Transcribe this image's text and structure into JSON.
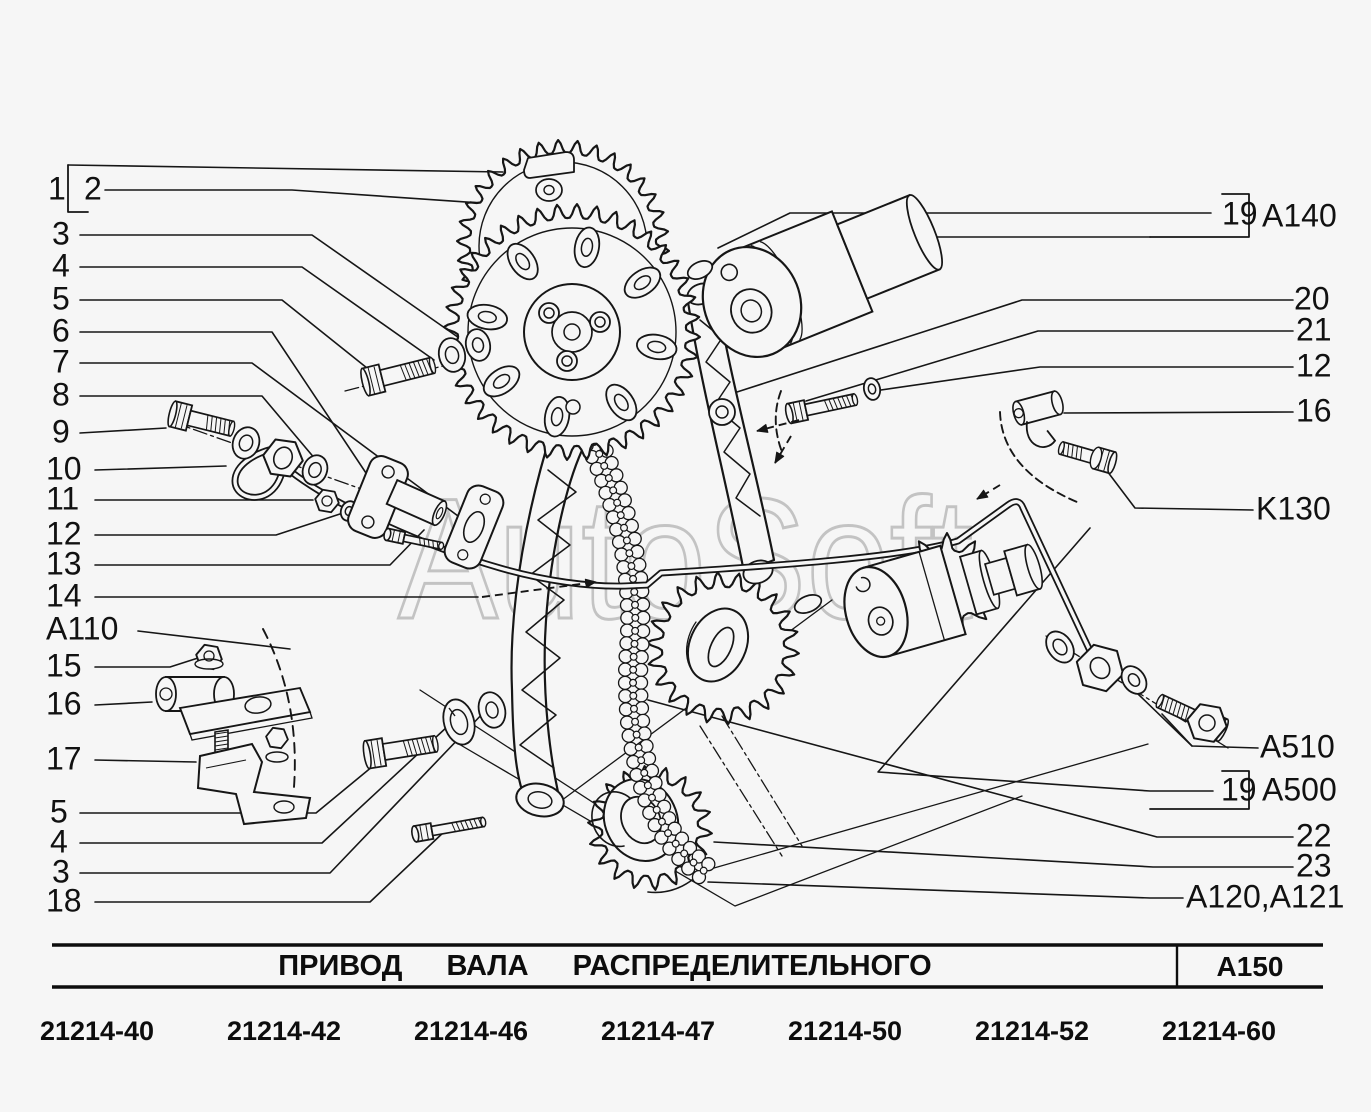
{
  "watermark": "AutoSoft",
  "callouts": {
    "left": [
      {
        "label": "1",
        "x": 48,
        "y": 190
      },
      {
        "label": "2",
        "x": 84,
        "y": 190,
        "boxed": true
      },
      {
        "label": "3",
        "x": 52,
        "y": 235
      },
      {
        "label": "4",
        "x": 52,
        "y": 267
      },
      {
        "label": "5",
        "x": 52,
        "y": 300
      },
      {
        "label": "6",
        "x": 52,
        "y": 332
      },
      {
        "label": "7",
        "x": 52,
        "y": 363
      },
      {
        "label": "8",
        "x": 52,
        "y": 396
      },
      {
        "label": "9",
        "x": 52,
        "y": 433
      },
      {
        "label": "10",
        "x": 46,
        "y": 470
      },
      {
        "label": "11",
        "x": 46,
        "y": 500
      },
      {
        "label": "12",
        "x": 46,
        "y": 535
      },
      {
        "label": "13",
        "x": 46,
        "y": 565
      },
      {
        "label": "14",
        "x": 46,
        "y": 597
      },
      {
        "label": "A110",
        "x": 46,
        "y": 630
      },
      {
        "label": "15",
        "x": 46,
        "y": 667
      },
      {
        "label": "16",
        "x": 46,
        "y": 705
      },
      {
        "label": "17",
        "x": 46,
        "y": 760
      },
      {
        "label": "5",
        "x": 50,
        "y": 813
      },
      {
        "label": "4",
        "x": 50,
        "y": 843
      },
      {
        "label": "3",
        "x": 52,
        "y": 873
      },
      {
        "label": "18",
        "x": 46,
        "y": 902
      }
    ],
    "right": [
      {
        "label": "19",
        "x": 1222,
        "y": 215,
        "boxed": true
      },
      {
        "label": "A140",
        "x": 1262,
        "y": 217
      },
      {
        "label": "20",
        "x": 1294,
        "y": 300
      },
      {
        "label": "21",
        "x": 1296,
        "y": 331
      },
      {
        "label": "12",
        "x": 1296,
        "y": 367
      },
      {
        "label": "16",
        "x": 1296,
        "y": 412
      },
      {
        "label": "K130",
        "x": 1256,
        "y": 510
      },
      {
        "label": "A510",
        "x": 1260,
        "y": 748
      },
      {
        "label": "19",
        "x": 1221,
        "y": 791,
        "boxed": true
      },
      {
        "label": "A500",
        "x": 1262,
        "y": 791
      },
      {
        "label": "22",
        "x": 1296,
        "y": 837
      },
      {
        "label": "23",
        "x": 1296,
        "y": 867
      },
      {
        "label": "A120,A121",
        "x": 1186,
        "y": 898
      }
    ]
  },
  "table": {
    "title": "ПРИВОД  ВАЛА  РАСПРЕДЕЛИТЕЛЬНОГО",
    "section_code": "A150",
    "codes": [
      "21214-40",
      "21214-42",
      "21214-46",
      "21214-47",
      "21214-50",
      "21214-52",
      "21214-60"
    ]
  },
  "colors": {
    "background": "#f6f6f6",
    "line": "#161616",
    "watermark": "#c3c3c3"
  }
}
